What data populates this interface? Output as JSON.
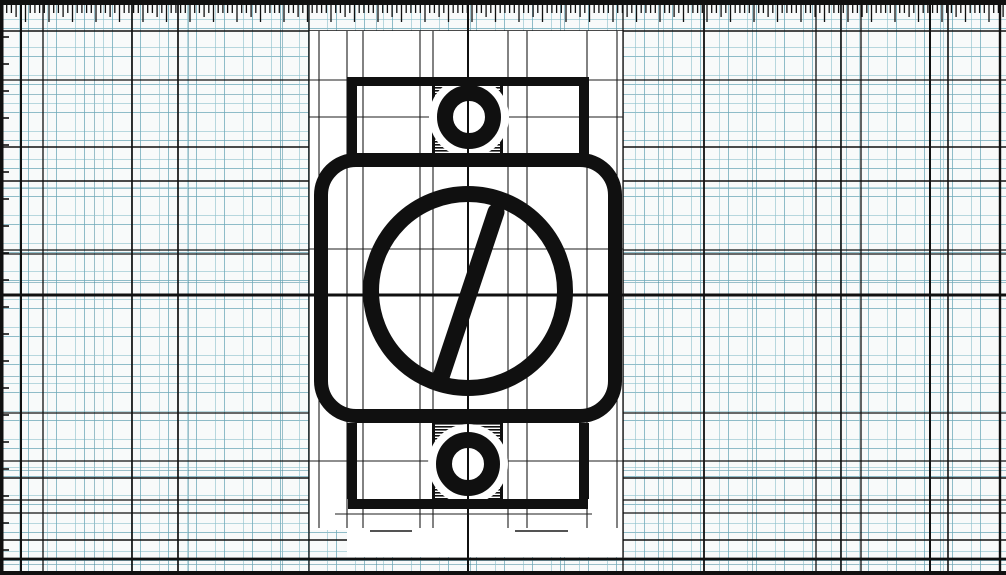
{
  "meta": {
    "title": "Engineering schematic symbol on graph paper",
    "width": 1006,
    "height": 575
  },
  "colors": {
    "paper": "#f8fafa",
    "sheet": "#ffffff",
    "ink": "#101010",
    "construction": "#1c1c1c",
    "grid_minor": "rgba(108,168,184,0.75)",
    "grid_sub": "rgba(140,192,204,0.6)",
    "grid_major": "rgba(60,132,152,0.5)"
  },
  "borders": {
    "top": {
      "x": 0,
      "y": 0,
      "w": 1006,
      "h": 5
    },
    "bottom": {
      "x": 0,
      "y": 571,
      "w": 1006,
      "h": 4
    },
    "left": {
      "x": 0,
      "y": 5,
      "w": 3,
      "h": 570
    }
  },
  "ruler_top": {
    "start_x": 2,
    "baseline_y": 5,
    "spacing": 4.7,
    "minor_len": 8,
    "mid_len": 12,
    "major_len": 17,
    "major_every": 5,
    "tick_width": 1.3
  },
  "ruler_left": {
    "start_y": 37,
    "spacing": 27,
    "len": 9,
    "tick_width": 1.6
  },
  "background_lines": {
    "vertical": [
      [
        2,
        3
      ],
      [
        21,
        2
      ],
      [
        43,
        1.3
      ],
      [
        132,
        1.7
      ],
      [
        178,
        1.7
      ],
      [
        309,
        1.3
      ],
      [
        623,
        1.3
      ],
      [
        704,
        1.8
      ],
      [
        816,
        1.3
      ],
      [
        841,
        1.6
      ],
      [
        861,
        1.3
      ],
      [
        930,
        2
      ],
      [
        948,
        1.6
      ],
      [
        1000,
        2.4
      ]
    ],
    "horizontal": [
      [
        31,
        1.6
      ],
      [
        80,
        1.2
      ],
      [
        147,
        1.5
      ],
      [
        181,
        1.5
      ],
      [
        250,
        1.2
      ],
      [
        254,
        1.2
      ],
      [
        413,
        1.2
      ],
      [
        461,
        1.3
      ],
      [
        478,
        1.5
      ],
      [
        500,
        1.3
      ],
      [
        513,
        1.3
      ],
      [
        540,
        1.5
      ],
      [
        559,
        2.8
      ]
    ]
  },
  "axes": {
    "vertical_x": 468,
    "vertical_w": 2,
    "horizontal_y": 295,
    "horizontal_w": 3
  },
  "sheet": {
    "x": 309,
    "y": 31,
    "w": 314,
    "h": 499,
    "ext_x": 347,
    "ext_y": 530,
    "ext_w": 276,
    "ext_h": 27
  },
  "construction": {
    "verticals": [
      319,
      347,
      363,
      420,
      433,
      508,
      527,
      587,
      617
    ],
    "v_top": 31,
    "v_bottom": 528,
    "horizontals": [
      80,
      117,
      249,
      461
    ],
    "h_left": 309,
    "h_right": 623,
    "segment": {
      "y": 514,
      "x1": 335,
      "x2": 592
    },
    "dashes": [
      {
        "y": 531,
        "x1": 370,
        "x2": 412
      },
      {
        "y": 531,
        "x1": 515,
        "x2": 568
      }
    ],
    "line_width": 1.1
  },
  "symbol": {
    "body": {
      "cx": 321,
      "cy": 160,
      "w": 294,
      "h": 256,
      "rx": 35,
      "stroke": 14
    },
    "dial_circle": {
      "cx": 468,
      "cy": 291,
      "r": 97,
      "stroke": 16
    },
    "slash": {
      "x1": 440,
      "y1": 380,
      "x2": 496,
      "y2": 212,
      "stroke": 17
    },
    "top_plate": {
      "x": 348,
      "y": 77,
      "w": 240,
      "h": 9
    },
    "bottom_plate": {
      "x": 348,
      "y": 499,
      "w": 240,
      "h": 10
    },
    "top_conn_left": {
      "x": 347,
      "y": 77,
      "w": 10,
      "h": 78
    },
    "top_conn_right": {
      "x": 579,
      "y": 77,
      "w": 10,
      "h": 78
    },
    "bottom_conn_left": {
      "x": 347,
      "y": 423,
      "w": 10,
      "h": 76
    },
    "bottom_conn_right": {
      "x": 579,
      "y": 423,
      "w": 10,
      "h": 76
    },
    "top_block": {
      "x": 432,
      "y": 84,
      "w": 71,
      "h": 70,
      "edge_w": 3
    },
    "bottom_block": {
      "x": 432,
      "y": 423,
      "w": 71,
      "h": 76,
      "edge_w": 3
    },
    "top_ring": {
      "cx": 469,
      "cy": 117,
      "r": 24,
      "stroke": 16,
      "halo_r": 40
    },
    "bottom_ring": {
      "cx": 468,
      "cy": 464,
      "r": 24,
      "stroke": 16,
      "halo_r": 40
    },
    "hatch": {
      "period": 3,
      "bar": 1.6
    }
  }
}
